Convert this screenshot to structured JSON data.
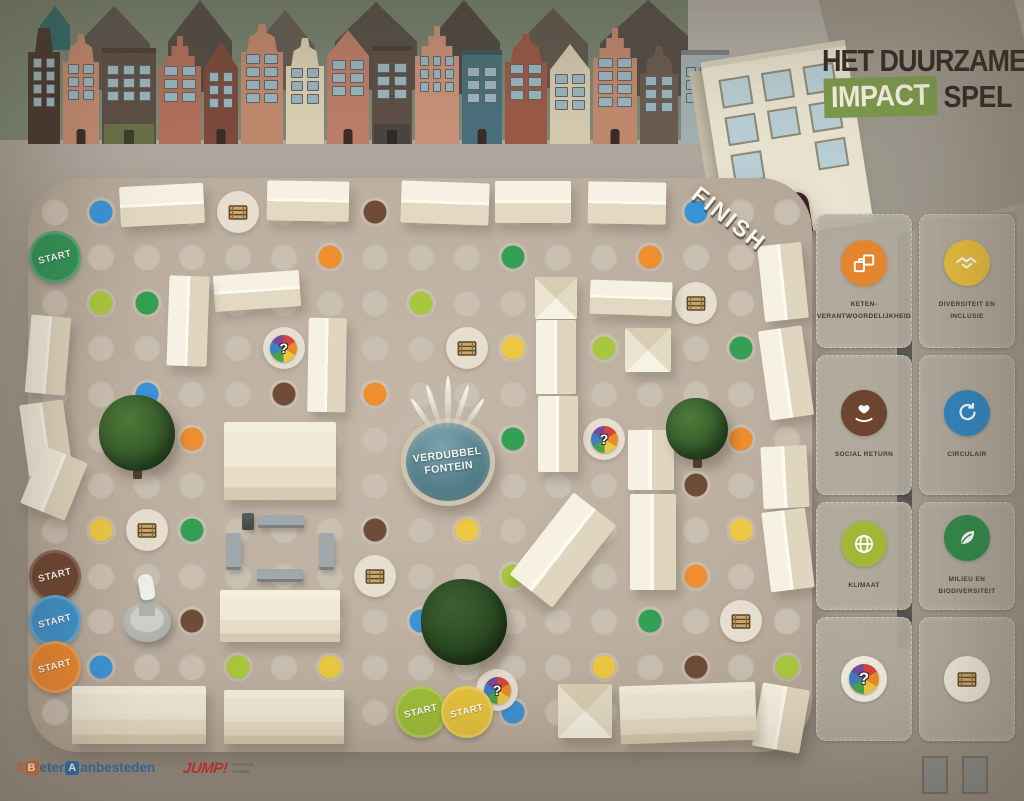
{
  "title": {
    "line1": "HET DUURZAME",
    "impact": "IMPACT",
    "spel": "SPEL"
  },
  "labels": {
    "finish": "FINISH",
    "start": "START",
    "question_mark": "?"
  },
  "fountain": {
    "line1": "VERDUBBEL",
    "line2": "FONTEIN"
  },
  "footer": {
    "beter_segments": [
      {
        "t": "#",
        "s": "hash"
      },
      {
        "t": "B",
        "s": "box-orange"
      },
      {
        "t": "eter",
        "s": "txt-blue"
      },
      {
        "t": "A",
        "s": "box-blue"
      },
      {
        "t": "anbesteden",
        "s": "txt-blue"
      }
    ],
    "jump": "JUMP!",
    "jump_sub1": "SERIOUS",
    "jump_sub2": "GAMES"
  },
  "colors": {
    "board": "#beb1a2",
    "accent_green": "#7d9a4c",
    "dots": {
      "green": "#33a053",
      "lime": "#a9c73e",
      "blue": "#3b93d6",
      "orange": "#ef8e2f",
      "yellow": "#ecc844",
      "brown": "#6f4c37"
    },
    "starts": {
      "green": "#2f9456",
      "brown": "#6d4531",
      "blue": "#3d92cc",
      "orange": "#e9862f",
      "lime": "#9fbe3a",
      "yellow": "#e7c33c"
    }
  },
  "cards": [
    {
      "label_lines": [
        "KETEN-",
        "VERANTWOORDELIJKHEID"
      ],
      "color": "#e5862f",
      "icon": "supply-chain"
    },
    {
      "label_lines": [
        "DIVERSITEIT EN",
        "INCLUSIE"
      ],
      "color": "#e9bf3d",
      "icon": "handshake"
    },
    {
      "label_lines": [
        "SOCIAL RETURN"
      ],
      "color": "#6d4531",
      "icon": "giving-hands"
    },
    {
      "label_lines": [
        "CIRCULAIR"
      ],
      "color": "#2f87c5",
      "icon": "circular-arrows"
    },
    {
      "label_lines": [
        "KLIMAAT"
      ],
      "color": "#a4b838",
      "icon": "globe"
    },
    {
      "label_lines": [
        "MILIEU EN",
        "BIODIVERSITEIT"
      ],
      "color": "#2f8b4d",
      "icon": "leaf"
    },
    {
      "label_lines": [],
      "color": "#f0ebdf",
      "icon": "chance-wheel"
    },
    {
      "label_lines": [],
      "color": "#f0ebdf",
      "icon": "crate"
    }
  ],
  "board": {
    "grid": {
      "x0": 55,
      "y0": 212,
      "dx": 45.75,
      "dy": 45.45,
      "cols": 17,
      "rows": 12
    },
    "colored_dots": [
      {
        "c": 1,
        "r": 0,
        "color": "blue"
      },
      {
        "c": 7,
        "r": 0,
        "color": "brown"
      },
      {
        "c": 14,
        "r": 0,
        "color": "blue"
      },
      {
        "c": 6,
        "r": 1,
        "color": "orange"
      },
      {
        "c": 10,
        "r": 1,
        "color": "green"
      },
      {
        "c": 13,
        "r": 1,
        "color": "orange"
      },
      {
        "c": 1,
        "r": 2,
        "color": "lime"
      },
      {
        "c": 2,
        "r": 2,
        "color": "green"
      },
      {
        "c": 8,
        "r": 2,
        "color": "lime"
      },
      {
        "c": 10,
        "r": 3,
        "color": "yellow"
      },
      {
        "c": 12,
        "r": 3,
        "color": "lime"
      },
      {
        "c": 15,
        "r": 3,
        "color": "green"
      },
      {
        "c": 2,
        "r": 4,
        "color": "blue"
      },
      {
        "c": 5,
        "r": 4,
        "color": "brown"
      },
      {
        "c": 7,
        "r": 4,
        "color": "orange"
      },
      {
        "c": 3,
        "r": 5,
        "color": "orange"
      },
      {
        "c": 10,
        "r": 5,
        "color": "green"
      },
      {
        "c": 15,
        "r": 5,
        "color": "orange"
      },
      {
        "c": 14,
        "r": 6,
        "color": "brown"
      },
      {
        "c": 16,
        "r": 6,
        "color": "blue"
      },
      {
        "c": 1,
        "r": 7,
        "color": "yellow"
      },
      {
        "c": 3,
        "r": 7,
        "color": "green"
      },
      {
        "c": 7,
        "r": 7,
        "color": "brown"
      },
      {
        "c": 9,
        "r": 7,
        "color": "yellow"
      },
      {
        "c": 15,
        "r": 7,
        "color": "yellow"
      },
      {
        "c": 10,
        "r": 8,
        "color": "lime"
      },
      {
        "c": 14,
        "r": 8,
        "color": "orange"
      },
      {
        "c": 3,
        "r": 9,
        "color": "brown"
      },
      {
        "c": 8,
        "r": 9,
        "color": "blue"
      },
      {
        "c": 13,
        "r": 9,
        "color": "green"
      },
      {
        "c": 1,
        "r": 10,
        "color": "blue"
      },
      {
        "c": 4,
        "r": 10,
        "color": "lime"
      },
      {
        "c": 6,
        "r": 10,
        "color": "yellow"
      },
      {
        "c": 12,
        "r": 10,
        "color": "yellow"
      },
      {
        "c": 14,
        "r": 10,
        "color": "brown"
      },
      {
        "c": 16,
        "r": 10,
        "color": "lime"
      },
      {
        "c": 10,
        "r": 11,
        "color": "blue"
      }
    ],
    "crate_spaces": [
      [
        4,
        0
      ],
      [
        14,
        2
      ],
      [
        9,
        3
      ],
      [
        2,
        7
      ],
      [
        7,
        8
      ],
      [
        15,
        9
      ]
    ],
    "wheel_spaces": [
      [
        5,
        3
      ],
      [
        12,
        5
      ]
    ],
    "wheel_free": [
      {
        "x": 497,
        "y": 690
      }
    ],
    "start_spaces": [
      {
        "c": 0,
        "r": 1,
        "color": "green"
      },
      {
        "c": 0,
        "r": 8,
        "color": "brown"
      },
      {
        "c": 0,
        "r": 9,
        "color": "blue"
      },
      {
        "c": 0,
        "r": 10,
        "color": "orange"
      },
      {
        "c": 8,
        "r": 11,
        "color": "lime"
      },
      {
        "c": 9,
        "r": 11,
        "color": "yellow"
      }
    ]
  },
  "scene": {
    "houses": [
      {
        "w": 32,
        "h": 116,
        "color": "#463730",
        "gable": "spout",
        "floors": 4,
        "cols": 2
      },
      {
        "w": 36,
        "h": 110,
        "color": "#c18a6f",
        "gable": "bell",
        "floors": 3,
        "cols": 2
      },
      {
        "w": 54,
        "h": 96,
        "color": "#5d4f46",
        "gable": "flat",
        "floors": 3,
        "cols": 3,
        "store": "#6a7049"
      },
      {
        "w": 42,
        "h": 108,
        "color": "#b2705b",
        "gable": "step",
        "floors": 3,
        "cols": 2
      },
      {
        "w": 34,
        "h": 102,
        "color": "#7d4a3c",
        "gable": "point",
        "floors": 3,
        "cols": 2
      },
      {
        "w": 42,
        "h": 120,
        "color": "#c18a6f",
        "gable": "bell",
        "floors": 4,
        "cols": 2
      },
      {
        "w": 38,
        "h": 106,
        "color": "#dcd1b5",
        "gable": "bell",
        "floors": 3,
        "cols": 2
      },
      {
        "w": 42,
        "h": 114,
        "color": "#bd7e69",
        "gable": "point",
        "floors": 3,
        "cols": 2
      },
      {
        "w": 40,
        "h": 98,
        "color": "#5d4f46",
        "gable": "flat",
        "floors": 3,
        "cols": 2,
        "store": "#4a4540"
      },
      {
        "w": 44,
        "h": 118,
        "color": "#c9927a",
        "gable": "step",
        "floors": 3,
        "cols": 3
      },
      {
        "w": 40,
        "h": 94,
        "color": "#49707c",
        "gable": "flat",
        "floors": 3,
        "cols": 2
      },
      {
        "w": 42,
        "h": 110,
        "color": "#9b5a47",
        "gable": "bell",
        "floors": 3,
        "cols": 2
      },
      {
        "w": 40,
        "h": 100,
        "color": "#d6cbb0",
        "gable": "point",
        "floors": 3,
        "cols": 2
      },
      {
        "w": 44,
        "h": 116,
        "color": "#c18a6f",
        "gable": "step",
        "floors": 4,
        "cols": 2
      },
      {
        "w": 38,
        "h": 98,
        "color": "#6a5b50",
        "gable": "bell",
        "floors": 3,
        "cols": 2
      },
      {
        "w": 48,
        "h": 94,
        "color": "#a3b0b2",
        "gable": "flat",
        "floors": 3,
        "cols": 3
      }
    ],
    "silhouettes": [
      {
        "x": 40,
        "y": 6,
        "w": 30,
        "h": 44,
        "c": "#2f6a6c"
      },
      {
        "x": 78,
        "y": 6,
        "w": 72,
        "h": 84,
        "c": "#5b554d"
      },
      {
        "x": 168,
        "y": 0,
        "w": 64,
        "h": 92,
        "c": "#524c45"
      },
      {
        "x": 255,
        "y": 10,
        "w": 60,
        "h": 80,
        "c": "#635d54"
      },
      {
        "x": 335,
        "y": 2,
        "w": 82,
        "h": 88,
        "c": "#564f48"
      },
      {
        "x": 428,
        "y": 0,
        "w": 72,
        "h": 94,
        "c": "#4e4841"
      },
      {
        "x": 518,
        "y": 8,
        "w": 70,
        "h": 80,
        "c": "#5f584f"
      },
      {
        "x": 600,
        "y": 0,
        "w": 96,
        "h": 96,
        "c": "#544d46"
      },
      {
        "x": 700,
        "y": 0,
        "w": 120,
        "h": 60,
        "c": "#575049"
      },
      {
        "x": 850,
        "y": 0,
        "w": 150,
        "h": 42,
        "c": "#5f5950"
      }
    ],
    "stalls": [
      [
        120,
        185,
        84,
        40,
        -3,
        "h"
      ],
      [
        267,
        181,
        82,
        40,
        1,
        "h"
      ],
      [
        401,
        182,
        88,
        42,
        2,
        "h"
      ],
      [
        495,
        181,
        76,
        42,
        0,
        "h"
      ],
      [
        588,
        182,
        78,
        42,
        1,
        "h"
      ],
      [
        214,
        273,
        86,
        36,
        -4,
        "h"
      ],
      [
        590,
        281,
        82,
        34,
        2,
        "h"
      ],
      [
        535,
        277,
        42,
        42,
        0,
        "p"
      ],
      [
        625,
        328,
        46,
        44,
        0,
        "p"
      ],
      [
        168,
        276,
        40,
        90,
        2,
        "v"
      ],
      [
        308,
        318,
        38,
        94,
        1,
        "v"
      ],
      [
        28,
        316,
        40,
        78,
        5,
        "v"
      ],
      [
        24,
        402,
        44,
        72,
        -8,
        "v"
      ],
      [
        30,
        452,
        48,
        62,
        22,
        "v"
      ],
      [
        224,
        422,
        112,
        78,
        0,
        "hb"
      ],
      [
        220,
        590,
        120,
        52,
        0,
        "hb"
      ],
      [
        536,
        320,
        40,
        74,
        0,
        "v"
      ],
      [
        538,
        396,
        40,
        76,
        0,
        "v"
      ],
      [
        628,
        430,
        46,
        60,
        0,
        "v"
      ],
      [
        630,
        494,
        46,
        96,
        0,
        "v"
      ],
      [
        536,
        498,
        54,
        104,
        38,
        "v"
      ],
      [
        761,
        244,
        44,
        76,
        -6,
        "v"
      ],
      [
        764,
        328,
        44,
        90,
        -8,
        "v"
      ],
      [
        762,
        446,
        46,
        62,
        -3,
        "v"
      ],
      [
        766,
        510,
        44,
        80,
        -7,
        "v"
      ],
      [
        757,
        686,
        48,
        64,
        10,
        "v"
      ],
      [
        72,
        686,
        134,
        58,
        0,
        "hb"
      ],
      [
        224,
        690,
        120,
        54,
        0,
        "hb"
      ],
      [
        558,
        684,
        54,
        54,
        0,
        "p"
      ],
      [
        620,
        684,
        136,
        58,
        -2,
        "hb"
      ]
    ],
    "trees": [
      {
        "x": 137,
        "y": 433,
        "r": 38,
        "trunk": true
      },
      {
        "x": 697,
        "y": 429,
        "r": 31,
        "trunk": true
      },
      {
        "x": 464,
        "y": 622,
        "r": 43,
        "dark": true
      }
    ],
    "benches": [
      [
        258,
        515,
        46,
        13
      ],
      [
        257,
        569,
        46,
        13
      ],
      [
        226,
        533,
        15,
        37
      ],
      [
        319,
        533,
        15,
        37
      ]
    ],
    "bin": [
      242,
      513,
      12,
      17
    ],
    "statue": {
      "x": 117,
      "y": 576
    }
  }
}
